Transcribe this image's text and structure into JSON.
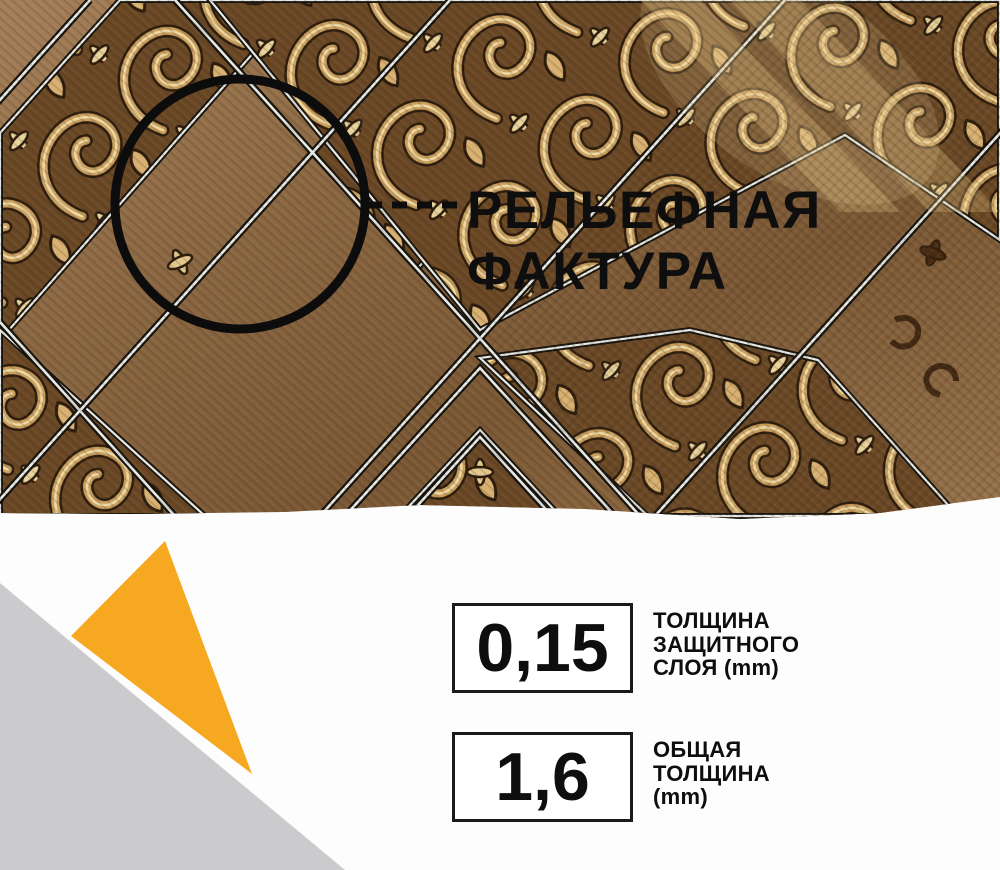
{
  "callout": {
    "line1": "РЕЛЬЕФНАЯ",
    "line2": "ФАКТУРА"
  },
  "specs": [
    {
      "value": "0,15",
      "label_lines": [
        "ТОЛЩИНА",
        "ЗАЩИТНОГО",
        "СЛОЯ (mm)"
      ]
    },
    {
      "value": "1,6",
      "label_lines": [
        "ОБЩАЯ",
        "ТОЛЩИНА",
        "(mm)"
      ]
    }
  ],
  "colors": {
    "accent_orange": "#F6A821",
    "triangle_gray": "#CBCBCD",
    "background_white": "#FDFDFD",
    "text_black": "#0E0E0E",
    "spec_box_border": "#1A1A1A",
    "wood_base": "#8A6742",
    "wood_dark_field": "#6A4826",
    "ornament_gold": "#C99F5E",
    "ornament_cream": "#EED9A4",
    "pinstripe_light": "#E6E9E6",
    "pinstripe_dark": "#15110B"
  }
}
